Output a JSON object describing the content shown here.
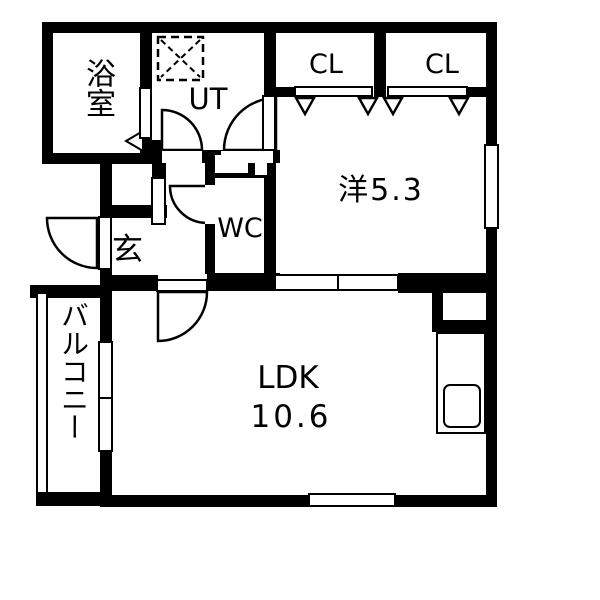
{
  "floorplan": {
    "colors": {
      "wall": "#000000",
      "background": "#ffffff"
    },
    "labels": {
      "bathroom": "浴室",
      "utility": "UT",
      "closet_left": "CL",
      "closet_right": "CL",
      "western_room": "洋5.3",
      "entrance": "玄",
      "toilet": "WC",
      "ldk": "LDK",
      "ldk_size": "10.6",
      "balcony": "バルコニー"
    }
  }
}
